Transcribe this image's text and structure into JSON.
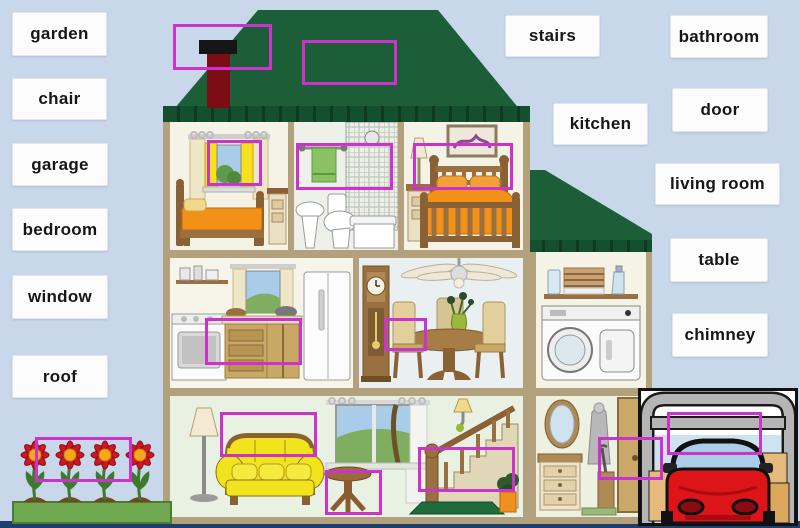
{
  "labels": {
    "left": [
      {
        "id": "garden",
        "text": "garden"
      },
      {
        "id": "chair",
        "text": "chair"
      },
      {
        "id": "garage",
        "text": "garage"
      },
      {
        "id": "bedroom",
        "text": "bedroom"
      },
      {
        "id": "window",
        "text": "window"
      },
      {
        "id": "roof",
        "text": "roof"
      }
    ],
    "right": [
      {
        "id": "stairs",
        "text": "stairs"
      },
      {
        "id": "bathroom",
        "text": "bathroom"
      },
      {
        "id": "kitchen",
        "text": "kitchen"
      },
      {
        "id": "door",
        "text": "door"
      },
      {
        "id": "living-room",
        "text": "living room"
      },
      {
        "id": "table",
        "text": "table"
      },
      {
        "id": "chimney",
        "text": "chimney"
      }
    ]
  },
  "highlight_boxes": [
    "chimney",
    "roof",
    "bedroom-window",
    "bathroom-towel",
    "bed",
    "kitchen-cabinets",
    "dining-chair",
    "sofa-back",
    "side-table",
    "stairs-post",
    "hall-umbrella-stand",
    "garage-door",
    "garden-flowers"
  ],
  "colors": {
    "background": "#c8d8ea",
    "highlight": "#cc33cc",
    "roof_green": "#1b5e38",
    "eave_green": "#14502e",
    "house_frame_tan": "#b2a17c",
    "wall_cream": "#f2efe2",
    "grass_green": "#6fa84e",
    "flower_red": "#cc1822",
    "flower_center_orange": "#f6a81c",
    "sofa_yellow": "#f2e41c",
    "bed_orange": "#f29018",
    "car_red": "#dd1418",
    "chimney_red": "#7d0d15",
    "towel_green": "#8bc163"
  }
}
